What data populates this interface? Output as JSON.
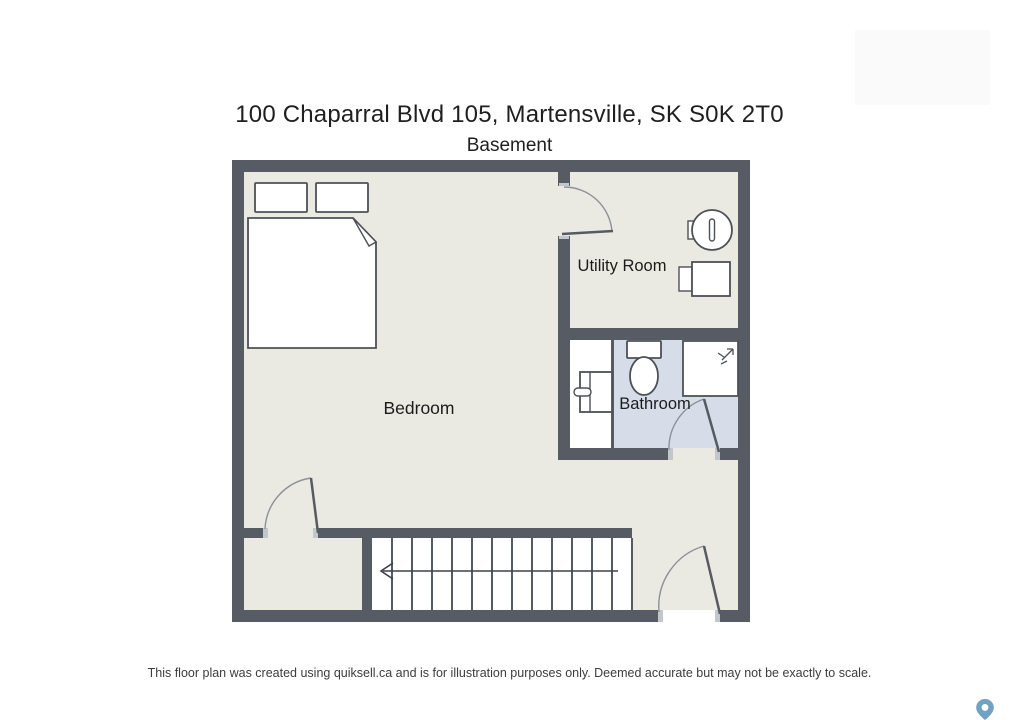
{
  "page": {
    "title": "100 Chaparral Blvd 105, Martensville, SK S0K 2T0",
    "subtitle": "Basement",
    "footer": "This floor plan was created using quiksell.ca and is for illustration purposes only. Deemed accurate but may not be exactly to scale."
  },
  "floor_plan": {
    "level_name": "Basement",
    "rooms": [
      {
        "label": "Bedroom",
        "floor_color": "#eaeae2",
        "fixtures": [
          "double-bed",
          "pillow",
          "pillow"
        ]
      },
      {
        "label": "Utility Room",
        "floor_color": "#eaeae2",
        "fixtures": [
          "washer",
          "dryer"
        ]
      },
      {
        "label": "Bathroom",
        "floor_color": "#d6dde9",
        "fixtures": [
          "vanity-unit",
          "toilet",
          "shower"
        ]
      }
    ],
    "stairs": {
      "treads": 13,
      "direction_arrow": "left"
    },
    "doors_count": 4,
    "colors": {
      "wall": "#575b63",
      "floor_main": "#eaeae2",
      "floor_bathroom": "#d6dde9",
      "fixture_outline": "#4d5157",
      "label_text": "#1c1c1c",
      "map_pin": "#72a2c3"
    }
  },
  "icons": {
    "map_pin": "location-pin"
  }
}
